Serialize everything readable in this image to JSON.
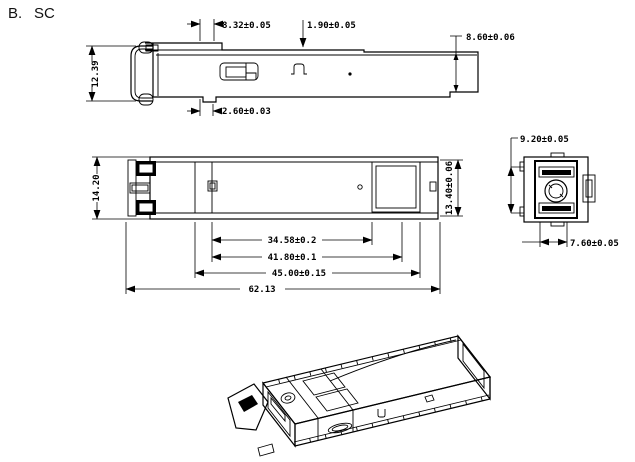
{
  "title": {
    "index": "B.",
    "connector_type": "SC"
  },
  "side_view": {
    "dims": {
      "tab_offset": "8.32±0.05",
      "recess_depth": "1.90±0.05",
      "body_height": "8.60±0.06",
      "front_height": "12.39",
      "bottom_offset": "2.60±0.03"
    }
  },
  "top_view": {
    "dims": {
      "overall_width": "14.20",
      "body_width": "13.40±0.06",
      "length_to_seam": "34.58±0.2",
      "length_to_notch": "41.80±0.1",
      "length_to_rear_stop": "45.00±0.15",
      "overall_length": "62.13"
    }
  },
  "end_view": {
    "dims": {
      "housing_height": "9.20±0.05",
      "port_width": "7.60±0.05"
    }
  },
  "colors": {
    "line": "#000000",
    "background": "#ffffff"
  }
}
